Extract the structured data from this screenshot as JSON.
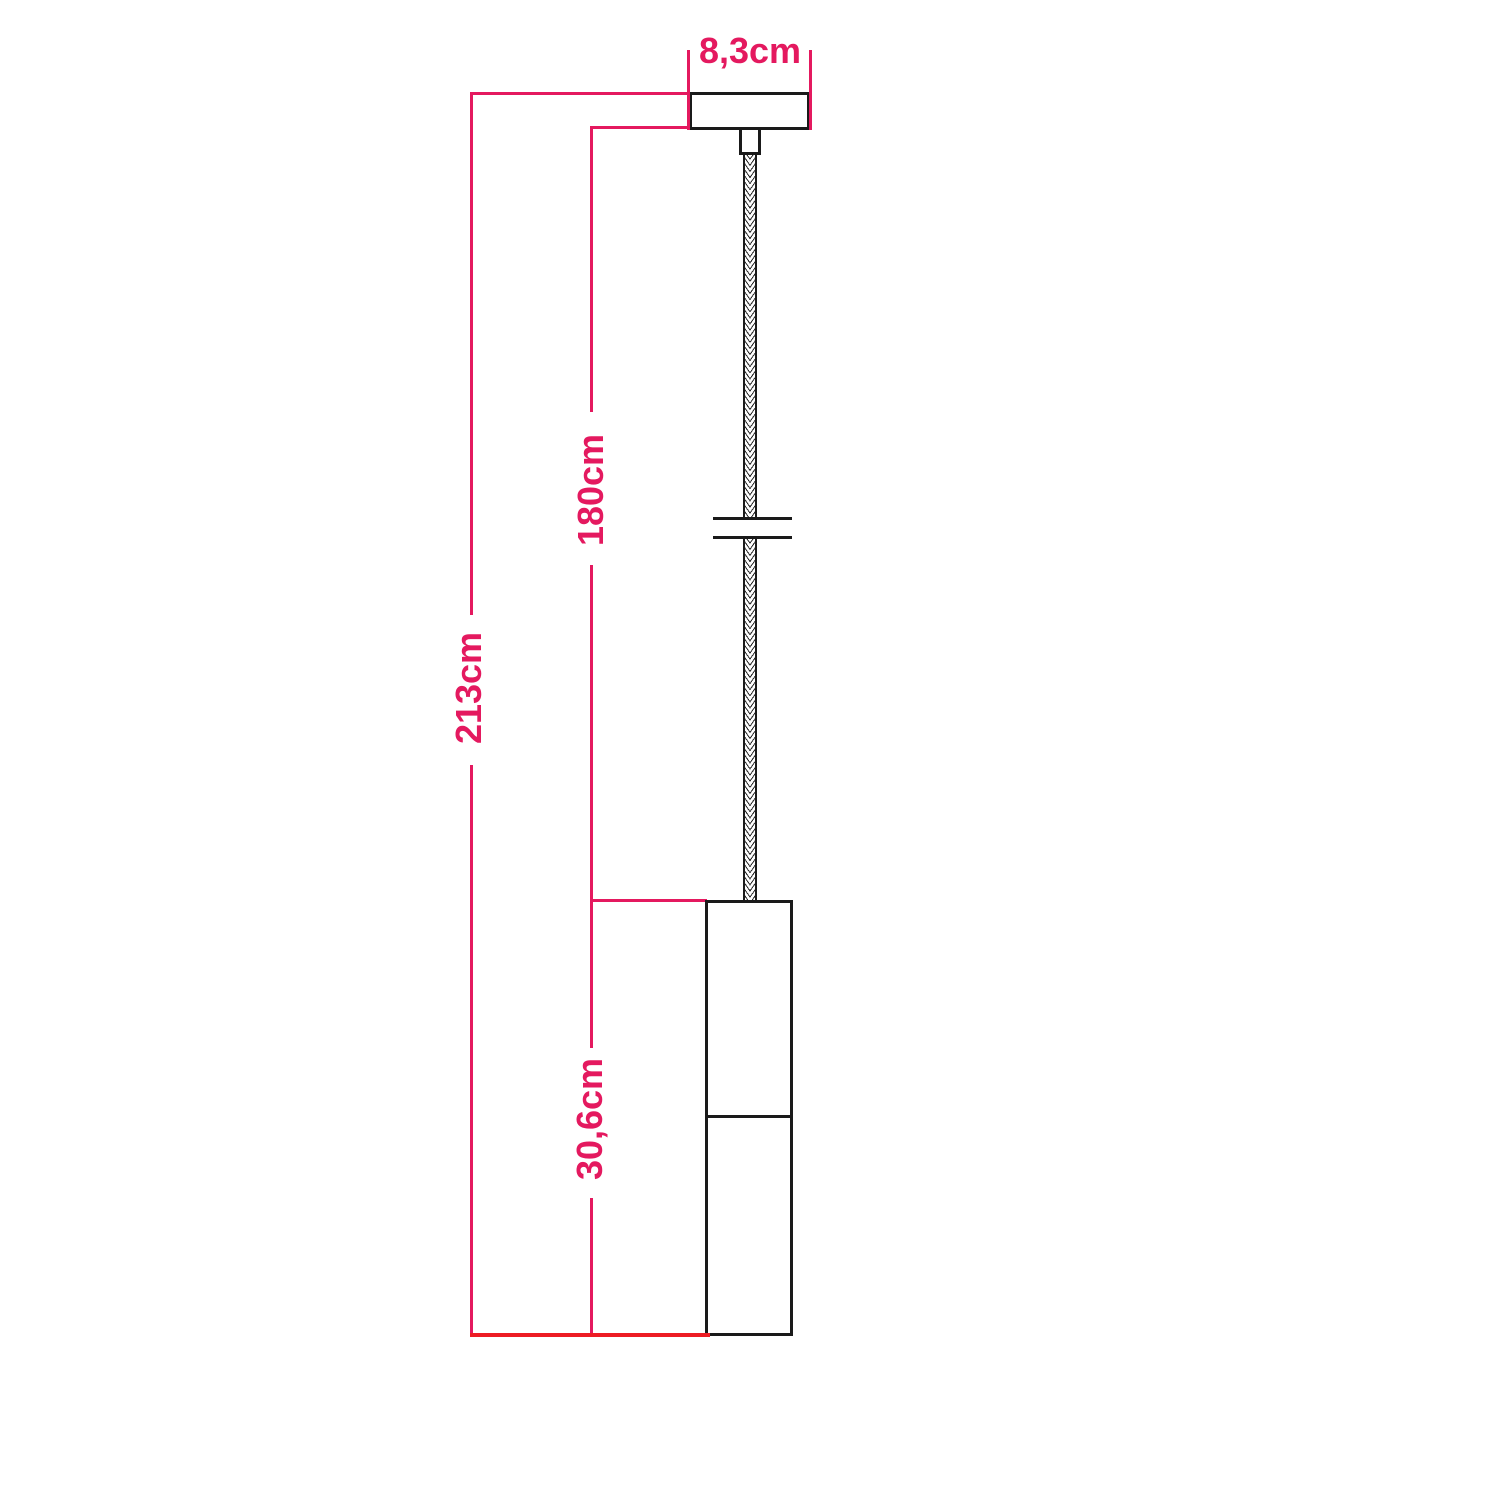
{
  "colors": {
    "dim": "#e4195f",
    "baseline": "#ed1c24",
    "line": "#1a1a1a",
    "bg": "#ffffff"
  },
  "dimensions": {
    "canopy_width": "8,3cm",
    "total_drop": "213cm",
    "cable_drop": "180cm",
    "lamp_height": "30,6cm"
  }
}
